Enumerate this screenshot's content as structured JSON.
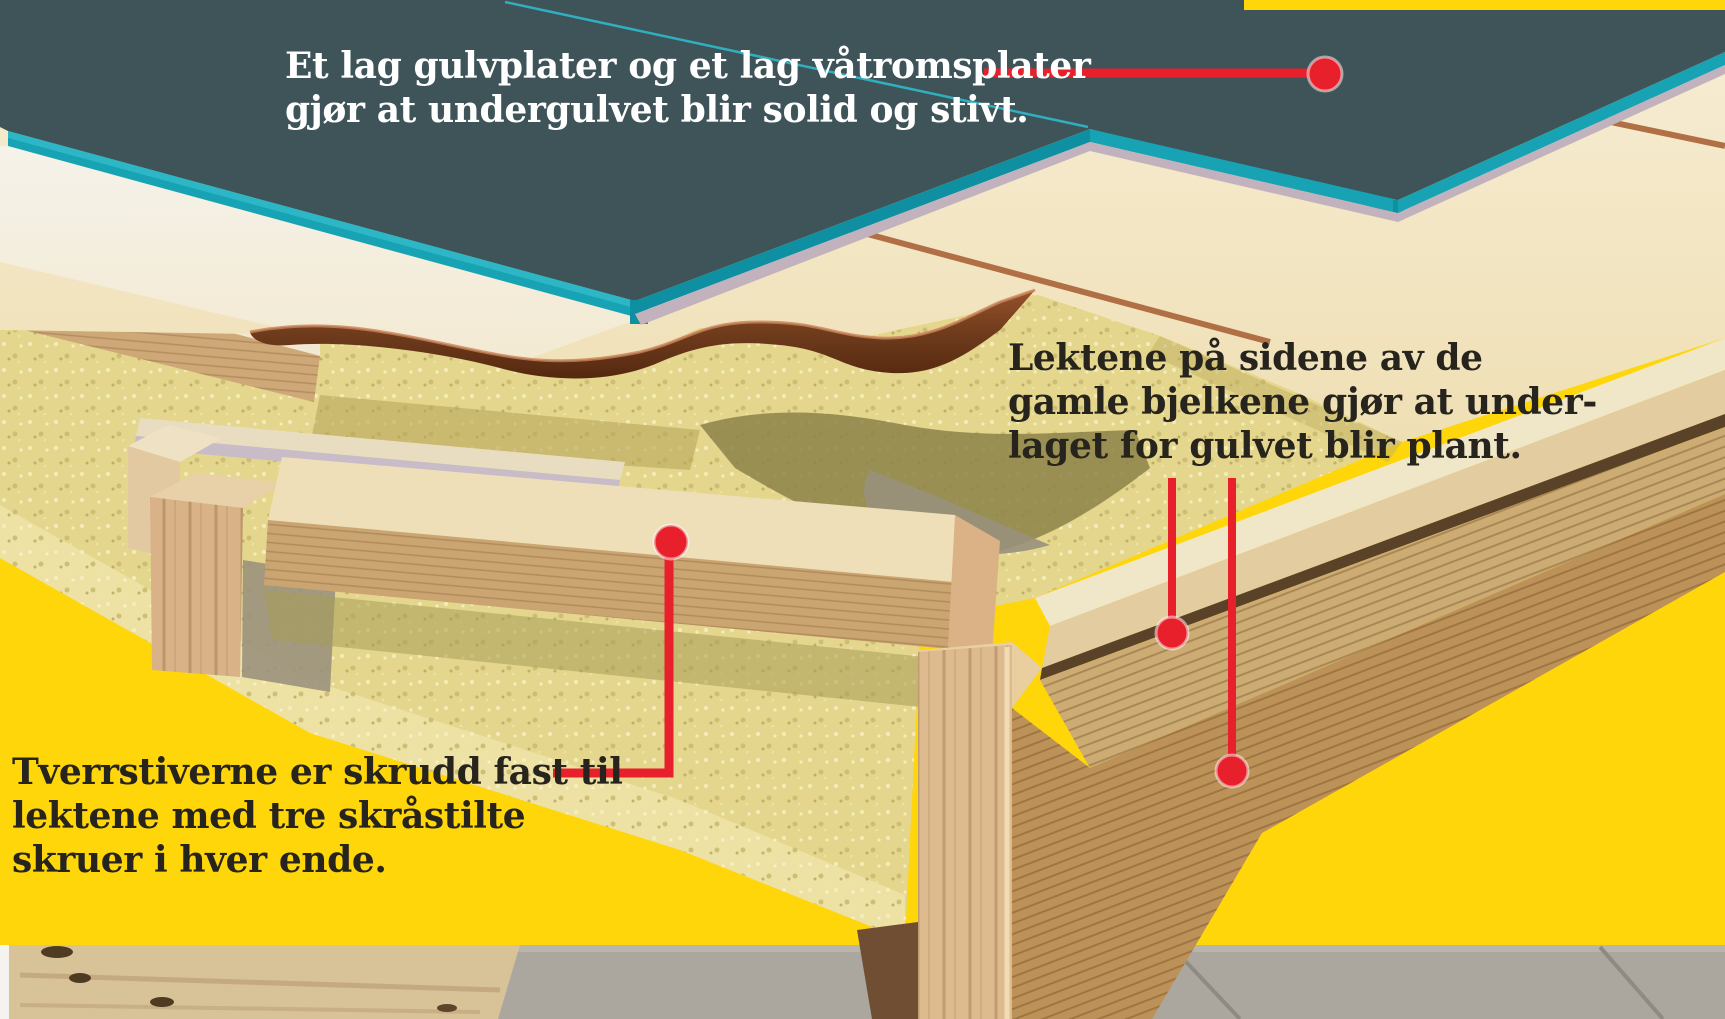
{
  "annotations": {
    "subfloor_layers": {
      "text": "Et lag gulvplater og et lag våtromsplater\ngjør at undergulvet blir solid og stivt."
    },
    "battens_on_joists": {
      "text": "Lektene på sidene av de\ngamle bjelkene gjør at under-\nlaget for gulvet blir plant."
    },
    "cross_braces": {
      "text": "Tverrstiverne er skrudd fast til\nlektene med tre skråstilte\nskruer i hver ende."
    }
  },
  "colors": {
    "bg_yellow": "#FFD60A",
    "wet_room_board_slate": "#3F5459",
    "board_edge_teal": "#17A3B4",
    "callout_red": "#E8202B",
    "text_dark": "#26241D",
    "text_light": "#FFFFFF"
  }
}
